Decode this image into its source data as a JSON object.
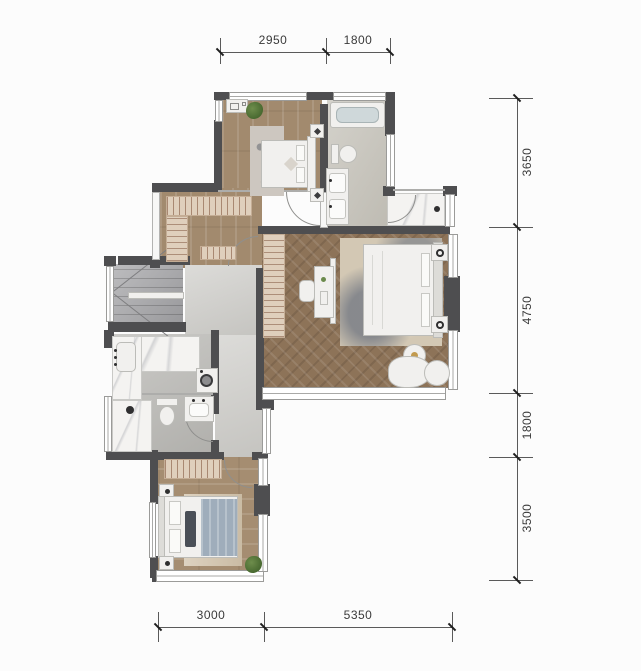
{
  "dimensions": {
    "top": [
      "2950",
      "1800"
    ],
    "right": [
      "3650",
      "4750",
      "1800",
      "3500"
    ],
    "bottom": [
      "3000",
      "5350"
    ]
  },
  "colors": {
    "wall": "#4e4e50",
    "wood_floor": "#a28a6e",
    "herringbone_floor": "#8d7358",
    "bathroom_tile": "#c6c3ba",
    "corridor_floor": "#cdccc8",
    "stair_floor": "#a6a6a9",
    "marble": "#f4f3f1",
    "bed_linen": "#f1f0ee",
    "blanket_blue": "#9fadbb",
    "closet_stripe": "#dfcfbc",
    "plant": "#47682f"
  },
  "icons": [
    "plant-icon",
    "washing-machine-icon",
    "bathtub-icon",
    "toilet-icon",
    "sink-icon",
    "shower-drain-icon",
    "stair-icon",
    "door-arc-icon",
    "wall-lamp-icon"
  ]
}
